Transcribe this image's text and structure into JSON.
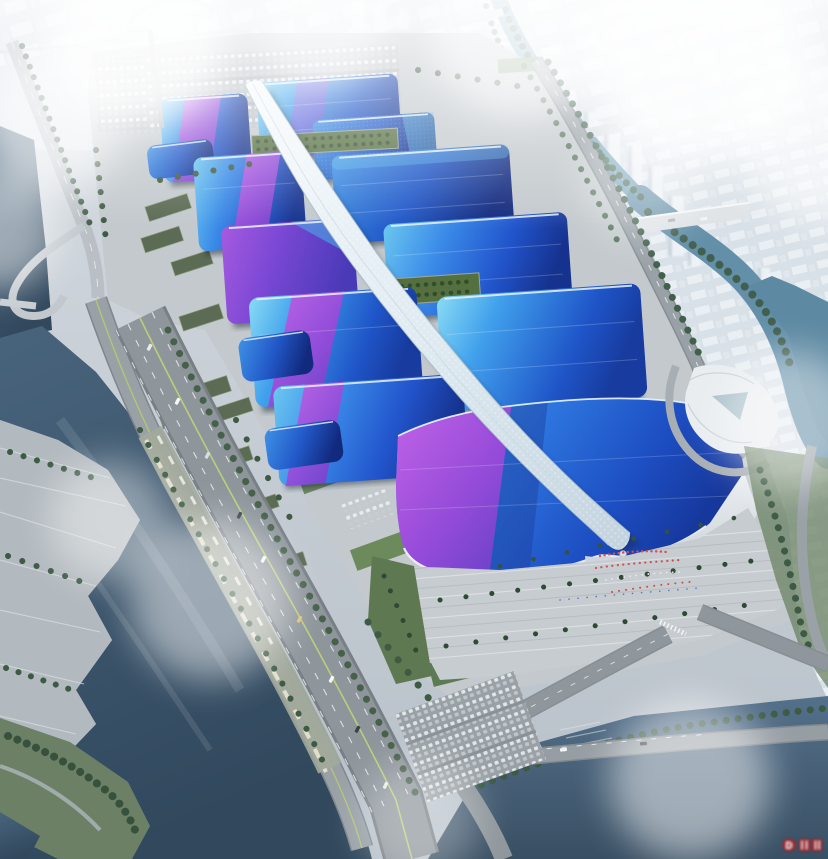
{
  "watermark": {
    "symbol": "D",
    "color": "#c21d1d"
  },
  "palette": {
    "hall_blue": "#2f7fe2",
    "hall_cyan": "#5ec1ee",
    "hall_purple": "#8a4fd8",
    "hall_magenta": "#b558e0",
    "spine_white": "#e9f1f7",
    "river_teal": "#6fa3b8",
    "water_dark": "#3d5970",
    "canal_dark": "#46617a",
    "plaza_gray": "#c6cbce",
    "road_gray": "#8e969c",
    "tree_green": "#3f5a42",
    "lawn_green": "#5e7852",
    "city_haze": "#dfe6ec",
    "fog_white": "#ffffff"
  }
}
